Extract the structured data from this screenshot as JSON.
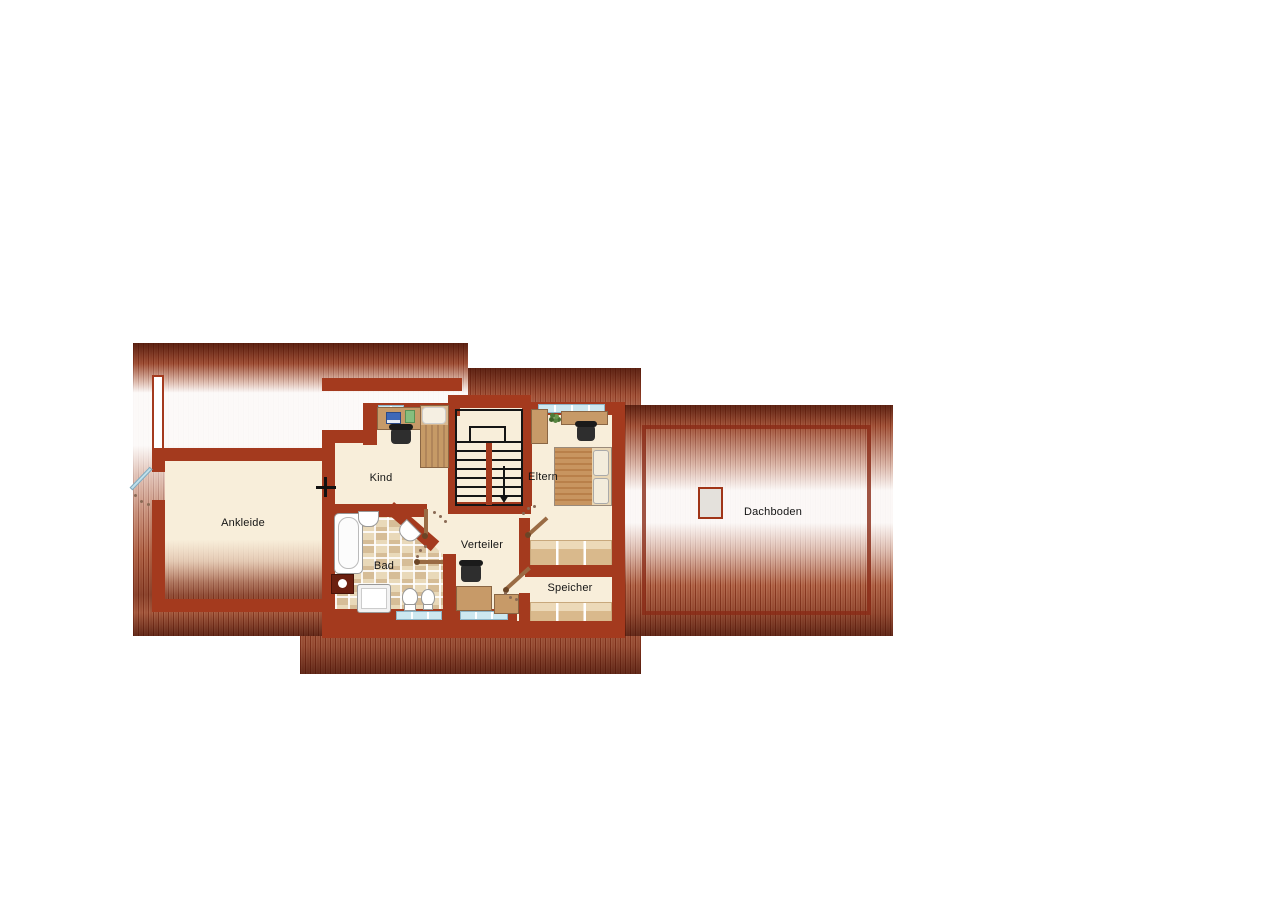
{
  "floorplan": {
    "type": "attic-floorplan",
    "rooms": [
      {
        "id": "ankleide",
        "label": "Ankleide"
      },
      {
        "id": "kind",
        "label": "Kind"
      },
      {
        "id": "eltern",
        "label": "Eltern"
      },
      {
        "id": "bad",
        "label": "Bad"
      },
      {
        "id": "verteiler",
        "label": "Verteiler"
      },
      {
        "id": "speicher",
        "label": "Speicher"
      },
      {
        "id": "dachboden",
        "label": "Dachboden"
      }
    ],
    "stairwell": {
      "direction": "down"
    },
    "features": [
      "bathtub",
      "shower",
      "toilet",
      "bidet",
      "sink",
      "double-bed",
      "single-bed",
      "desk",
      "office-chair",
      "wardrobe",
      "plant",
      "skylight",
      "knee-wall-cabinets",
      "chimney"
    ],
    "colors": {
      "wall": "#A43A1E",
      "floor": "#F8EEDA",
      "window": "#CDE8F0",
      "furniture": "#C79A68",
      "roof-dark": "#6E2413",
      "roof-base": "#B4664A",
      "tile-light": "#E9D9B9",
      "tile-dark": "#D6BD97",
      "door-leaf": "#9A6B44",
      "glass-door": "#BFE0EC"
    }
  }
}
